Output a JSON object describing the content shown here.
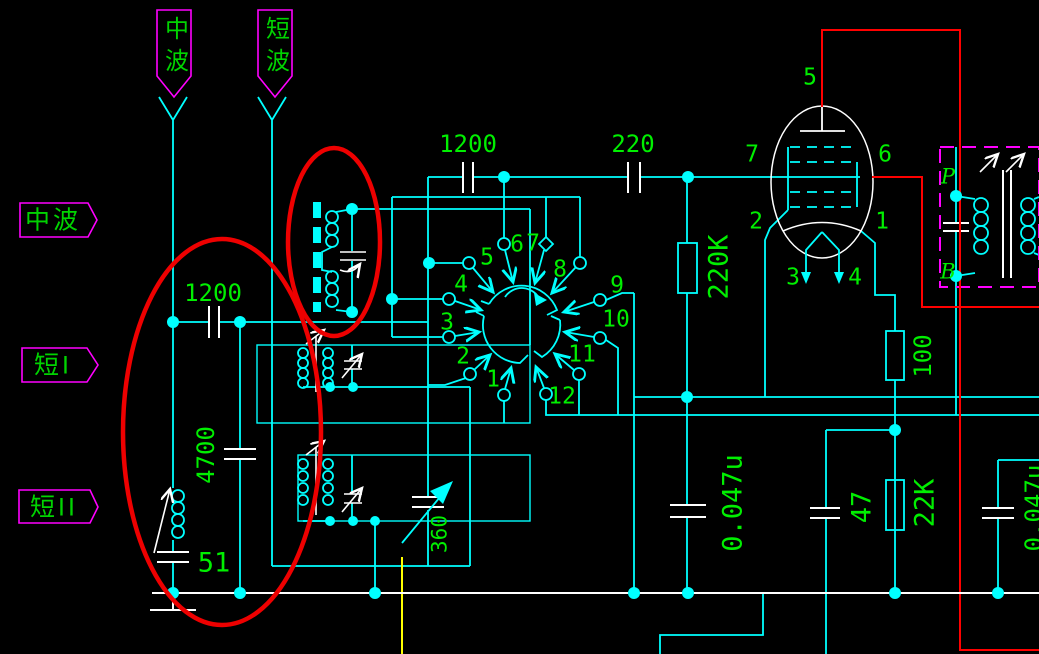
{
  "colors": {
    "background": "#000000",
    "wire": "#00ffff",
    "value_text": "#00ef00",
    "supply_wire": "#ff0000",
    "highlight_ellipse": "#ee0000",
    "annotation_outline": "#ff00ff",
    "component_plate": "#ffffff",
    "special_wire": "#ffff00"
  },
  "banners": {
    "medium_wave": "中波",
    "short_wave": "短波"
  },
  "band_labels": {
    "medium_wave": "中波",
    "short_one": "短I",
    "short_two": "短II"
  },
  "values": {
    "antenna_cap": "1200",
    "padder_cap": "4700",
    "osc_cap": "51",
    "coupling_cap_1": "1200",
    "coupling_cap_2": "220",
    "grid_resistor": "220K",
    "tuning_cap": "360",
    "bypass_cap": "0.047u",
    "cathode_resistor": "100",
    "cathode_cap": "47",
    "cathode_resistor_2": "22K",
    "right_edge_cap": "0.047u"
  },
  "switch": {
    "contacts": [
      "1",
      "2",
      "3",
      "4",
      "5",
      "6",
      "7",
      "8",
      "9",
      "10",
      "11",
      "12"
    ]
  },
  "tube": {
    "pin1": "1",
    "pin2": "2",
    "pin3": "3",
    "pin4": "4",
    "pin5": "5",
    "pin6": "6",
    "pin7": "7"
  },
  "output_transformer": {
    "primary": "P",
    "secondary": "B"
  }
}
